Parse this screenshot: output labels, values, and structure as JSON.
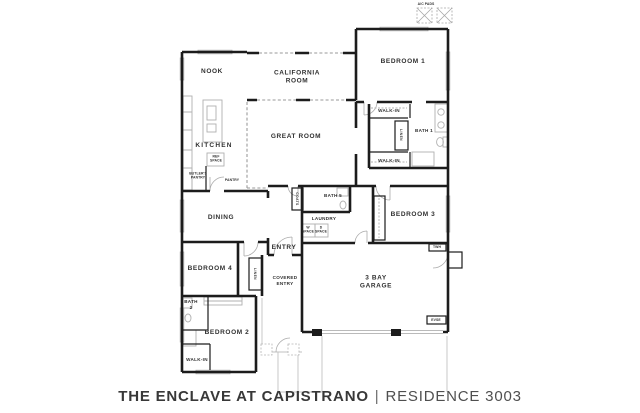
{
  "title": {
    "project": "THE ENCLAVE AT CAPISTRANO",
    "divider": "|",
    "residence": "RESIDENCE 3003"
  },
  "site": {
    "ac_pads": "A/C PADS",
    "twh": "TWH",
    "evse": "EVSE"
  },
  "rooms": {
    "nook": "NOOK",
    "california_room": "CALIFORNIA ROOM",
    "bedroom_1": "BEDROOM 1",
    "kitchen": "KITCHEN",
    "great_room": "GREAT ROOM",
    "ref_space": "REF SPACE",
    "butlers_pantry": "BUTLER'S PANTRY",
    "pantry": "PANTRY",
    "walk_in_top": "WALK-IN",
    "linen_1": "LINEN",
    "bath_1": "BATH 1",
    "walk_in_bottom": "WALK-IN",
    "coats": "COATS",
    "bath_5": "BATH 5",
    "laundry": "LAUNDRY",
    "w_space": "W SPACE",
    "d_space": "D SPACE",
    "bedroom_3": "BEDROOM 3",
    "dining": "DINING",
    "entry": "ENTRY",
    "linen_2": "LINEN",
    "covered_entry": "COVERED ENTRY",
    "bedroom_4": "BEDROOM 4",
    "bath_2": "BATH 2",
    "bedroom_2": "BEDROOM 2",
    "walk_in_2": "WALK-IN",
    "garage": "3 BAY GARAGE"
  }
}
